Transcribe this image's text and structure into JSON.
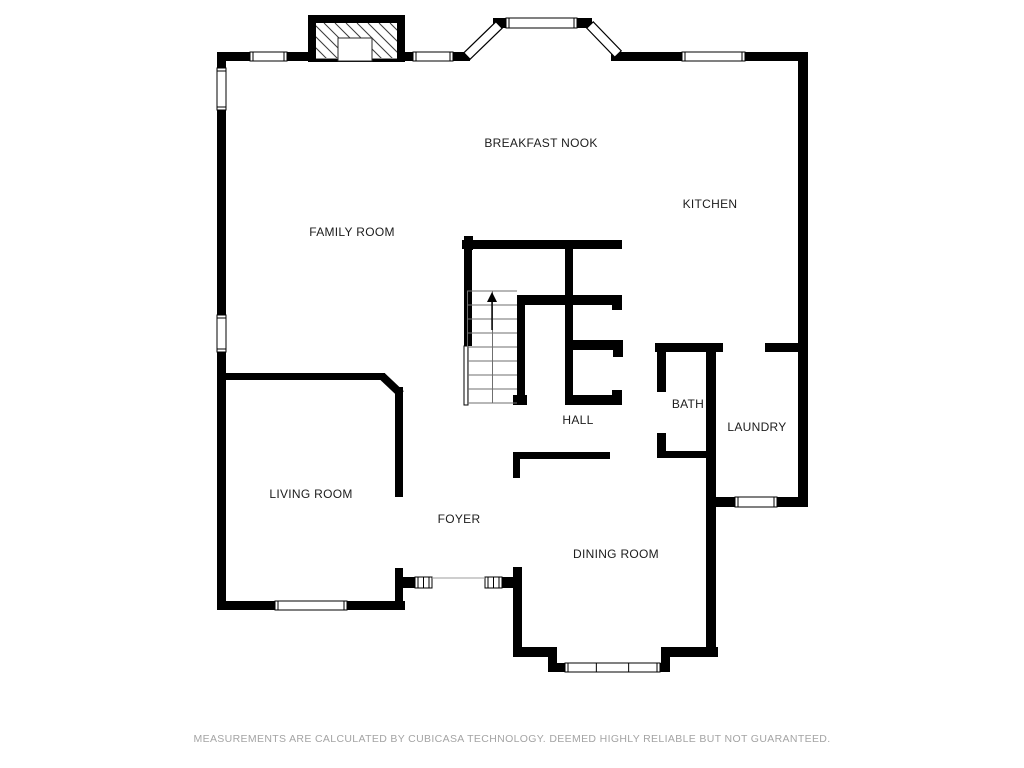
{
  "footer": {
    "text": "MEASUREMENTS ARE CALCULATED BY CUBICASA TECHNOLOGY. DEEMED HIGHLY RELIABLE BUT NOT GUARANTEED."
  },
  "colors": {
    "wall": "#000000",
    "label": "#1c1c1c",
    "footer_text": "#a4a4a4",
    "background": "#ffffff",
    "step_line": "#6f6f6f",
    "door_line": "#9c9c9c",
    "window_fill": "#ffffff"
  },
  "rooms": [
    {
      "id": "breakfast-nook",
      "label": "BREAKFAST NOOK",
      "x": 541,
      "y": 143
    },
    {
      "id": "kitchen",
      "label": "KITCHEN",
      "x": 710,
      "y": 204
    },
    {
      "id": "family-room",
      "label": "FAMILY ROOM",
      "x": 352,
      "y": 232
    },
    {
      "id": "hall",
      "label": "HALL",
      "x": 578,
      "y": 420
    },
    {
      "id": "bath",
      "label": "BATH",
      "x": 688,
      "y": 404
    },
    {
      "id": "laundry",
      "label": "LAUNDRY",
      "x": 757,
      "y": 427
    },
    {
      "id": "living-room",
      "label": "LIVING ROOM",
      "x": 311,
      "y": 494
    },
    {
      "id": "foyer",
      "label": "FOYER",
      "x": 459,
      "y": 519
    },
    {
      "id": "dining-room",
      "label": "DINING ROOM",
      "x": 616,
      "y": 554
    }
  ],
  "floorplan": {
    "walls": [
      [
        217,
        52,
        33,
        9
      ],
      [
        287,
        52,
        21,
        9
      ],
      [
        405,
        52,
        8,
        9
      ],
      [
        453,
        52,
        17,
        9
      ],
      [
        611,
        52,
        10,
        9
      ],
      [
        620,
        52,
        62,
        9
      ],
      [
        745,
        52,
        53,
        9
      ],
      [
        493,
        18,
        14,
        10
      ],
      [
        577,
        18,
        15,
        10
      ],
      [
        798,
        52,
        10,
        455
      ],
      [
        217,
        52,
        9,
        16
      ],
      [
        217,
        110,
        9,
        205
      ],
      [
        217,
        352,
        9,
        249
      ],
      [
        217,
        601,
        188,
        9
      ],
      [
        222,
        373,
        163,
        7
      ],
      [
        395,
        387,
        8,
        110
      ],
      [
        395,
        568,
        8,
        41
      ],
      [
        403,
        577,
        12,
        11
      ],
      [
        502,
        577,
        12,
        11
      ],
      [
        513,
        567,
        9,
        90
      ],
      [
        513,
        647,
        44,
        10
      ],
      [
        548,
        647,
        9,
        25
      ],
      [
        548,
        663,
        122,
        9
      ],
      [
        661,
        647,
        9,
        25
      ],
      [
        661,
        647,
        57,
        10
      ],
      [
        706,
        343,
        10,
        314
      ],
      [
        513,
        452,
        97,
        7
      ],
      [
        513,
        452,
        7,
        26
      ],
      [
        655,
        343,
        68,
        9
      ],
      [
        765,
        343,
        33,
        9
      ],
      [
        657,
        352,
        9,
        40
      ],
      [
        657,
        433,
        9,
        25
      ],
      [
        657,
        451,
        50,
        7
      ],
      [
        706,
        497,
        102,
        10
      ],
      [
        464,
        236,
        9,
        14
      ],
      [
        462,
        240,
        160,
        9
      ],
      [
        464,
        249,
        8,
        97
      ],
      [
        517,
        295,
        105,
        10
      ],
      [
        612,
        305,
        10,
        5
      ],
      [
        517,
        305,
        8,
        91
      ],
      [
        513,
        395,
        14,
        10
      ],
      [
        565,
        249,
        8,
        156
      ],
      [
        573,
        340,
        42,
        10
      ],
      [
        613,
        340,
        10,
        17
      ],
      [
        565,
        395,
        57,
        10
      ],
      [
        612,
        390,
        10,
        15
      ]
    ],
    "thin_walls": [
      [
        464,
        346,
        4,
        59
      ]
    ],
    "diagonal_walls": [
      {
        "x1": 382,
        "y1": 376,
        "x2": 401,
        "y2": 394,
        "w": 8
      }
    ],
    "windows": [
      {
        "x": 250,
        "y": 52,
        "w": 37,
        "h": 9,
        "div": []
      },
      {
        "x": 413,
        "y": 52,
        "w": 40,
        "h": 9,
        "div": []
      },
      {
        "x": 506,
        "y": 18,
        "w": 71,
        "h": 10,
        "div": []
      },
      {
        "x": 682,
        "y": 52,
        "w": 63,
        "h": 9,
        "div": []
      },
      {
        "x": 217,
        "y": 68,
        "w": 9,
        "h": 42,
        "div": []
      },
      {
        "x": 217,
        "y": 315,
        "w": 9,
        "h": 37,
        "div": []
      },
      {
        "x": 275,
        "y": 601,
        "w": 72,
        "h": 9,
        "div": []
      },
      {
        "x": 565,
        "y": 663,
        "w": 95,
        "h": 9,
        "div": [
          0.33,
          0.67
        ]
      },
      {
        "x": 735,
        "y": 497,
        "w": 42,
        "h": 10,
        "div": []
      },
      {
        "x": 415,
        "y": 577,
        "w": 17,
        "h": 11,
        "div": [
          0.5
        ]
      },
      {
        "x": 485,
        "y": 577,
        "w": 17,
        "h": 11,
        "div": [
          0.5
        ]
      }
    ],
    "diagonal_windows": [
      {
        "x1": 467,
        "y1": 56,
        "x2": 499,
        "y2": 25,
        "w": 9
      },
      {
        "x1": 590,
        "y1": 25,
        "x2": 618,
        "y2": 54,
        "w": 9
      }
    ],
    "door_lines": [
      [
        432,
        578,
        485,
        578
      ]
    ],
    "stairs": {
      "x": 467,
      "y": 291,
      "w": 50,
      "h": 112,
      "steps": 9,
      "divider_x": 492,
      "arrow": {
        "x": 492,
        "y_tail": 330,
        "y_head": 302,
        "head_w": 10,
        "head_h": 10
      }
    },
    "fireplace": {
      "outer": [
        308,
        15,
        97,
        47
      ],
      "inner": [
        316,
        23,
        81,
        36
      ],
      "firebox": [
        338,
        38,
        34,
        23
      ],
      "hatch_spacing": 11,
      "bottom_line_y": 58.5
    }
  }
}
